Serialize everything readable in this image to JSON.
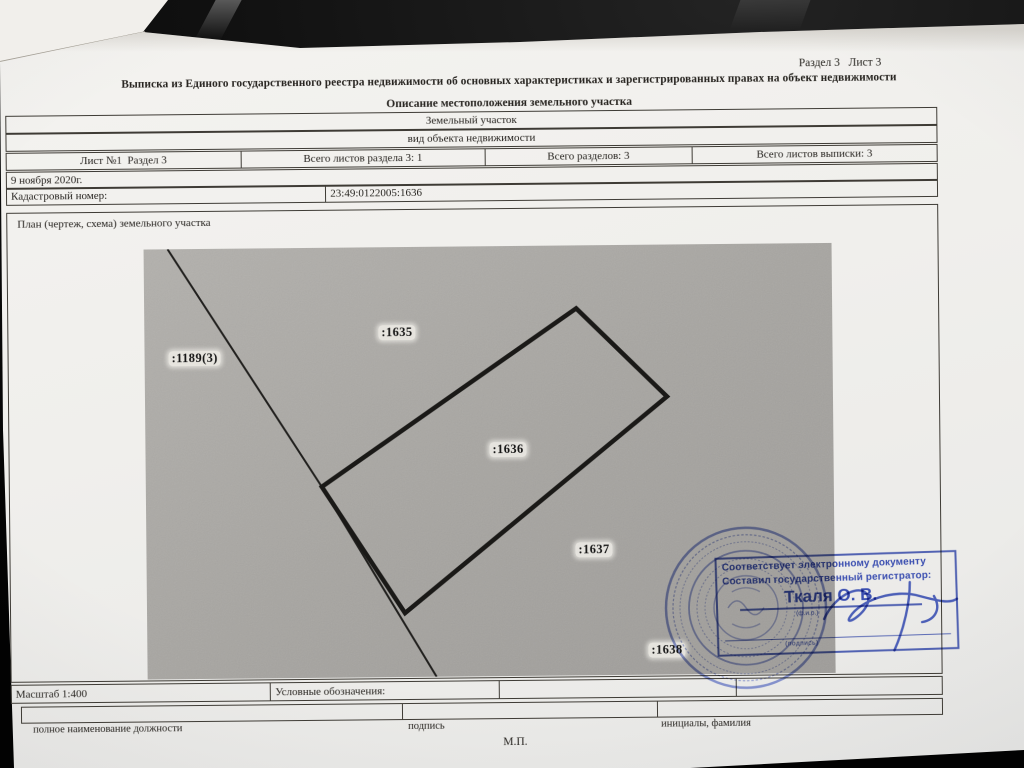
{
  "page_header": {
    "section_label": "Раздел 3   Лист 3",
    "title": "Выписка из Единого государственного реестра недвижимости об основных характеристиках и зарегистрированных правах на объект недвижимости",
    "subtitle": "Описание местоположения земельного участка"
  },
  "object_table": {
    "object_type": "Земельный участок",
    "object_type_caption": "вид объекта недвижимости",
    "sheet_info": [
      "Лист №1  Раздел 3",
      "Всего листов раздела 3: 1",
      "Всего разделов: 3",
      "Всего листов выписки: 3"
    ],
    "date": "9 ноября 2020г.",
    "cadastral_label": "Кадастровый номер:",
    "cadastral_number": "23:49:0122005:1636"
  },
  "plan": {
    "title": "План (чертеж, схема) земельного участка",
    "parcel_labels": [
      ":1189(3)",
      ":1635",
      ":1636",
      ":1637",
      ":1638"
    ]
  },
  "stamp": {
    "line1": "Соответствует электронному документу",
    "line2": "Составил государственный регистратор:",
    "registrar_name": "Ткаля О. В.",
    "name_caption": "(ф.и.о.)",
    "signature_caption": "(подпись)"
  },
  "footer": {
    "scale": "Масштаб 1:400",
    "legend_label": "Условные обозначения:",
    "position_caption": "полное наименование должности",
    "signature_caption": "подпись",
    "name_caption": "инициалы, фамилия",
    "seal_mark": "М.П."
  },
  "colors": {
    "stamp_blue": "#3a4eb0",
    "map_gray": "#a9a7a3",
    "paper": "#f1f0ed",
    "ink": "#272420"
  }
}
